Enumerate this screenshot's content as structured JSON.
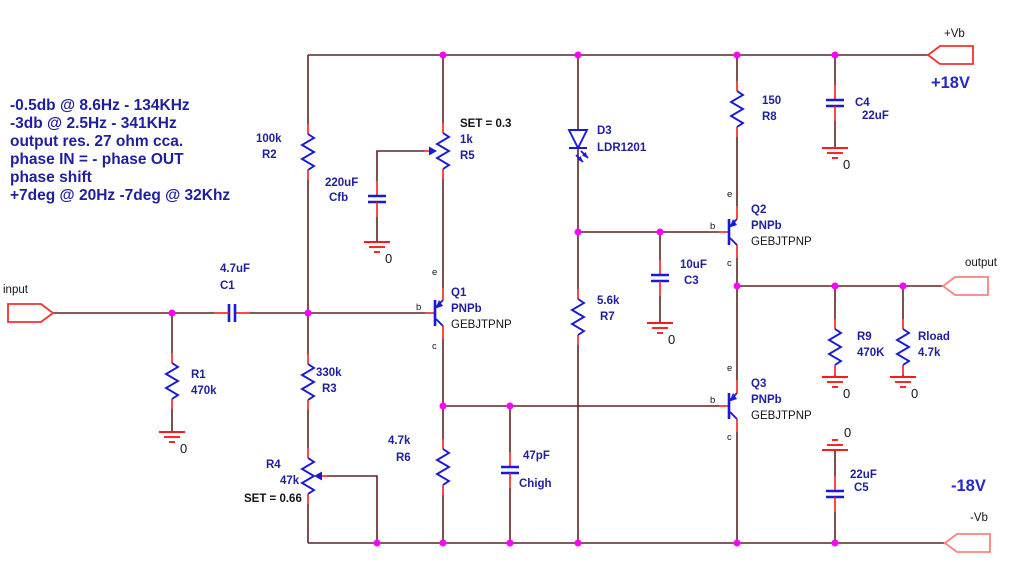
{
  "colors": {
    "wire": "#5f2424",
    "pin": "#ff1a1a",
    "body": "#1a1ad6",
    "dot": "#ff00ff",
    "label": "#1f1f9e",
    "ink": "#141414",
    "big": "#2626c9",
    "port": "#f53030",
    "portLight": "#ff8080",
    "bg": "#ffffff"
  },
  "annotations": {
    "lines": [
      "-0.5db @ 8.6Hz - 134KHz",
      "-3db @ 2.5Hz - 341KHz",
      "output res. 27 ohm cca.",
      "phase IN = - phase OUT",
      "phase shift",
      "+7deg @ 20Hz -7deg @ 32Khz"
    ]
  },
  "ports": {
    "input": {
      "label": "input"
    },
    "output": {
      "label": "output"
    },
    "vb_pos": {
      "label": "+Vb",
      "voltage": "+18V"
    },
    "vb_neg": {
      "label": "-Vb",
      "voltage": "-18V"
    }
  },
  "ground": {
    "label": "0"
  },
  "pins": {
    "e": "e",
    "b": "b",
    "c": "c"
  },
  "components": {
    "r1": {
      "ref": "R1",
      "value": "470k"
    },
    "r2": {
      "ref": "R2",
      "value": "100k"
    },
    "r3": {
      "ref": "R3",
      "value": "330k"
    },
    "r4": {
      "ref": "R4",
      "value": "47k",
      "set": "SET = 0.66"
    },
    "r5": {
      "ref": "R5",
      "value": "1k",
      "set": "SET = 0.3"
    },
    "r6": {
      "ref": "R6",
      "value": "4.7k"
    },
    "r7": {
      "ref": "R7",
      "value": "5.6k"
    },
    "r8": {
      "ref": "R8",
      "value": "150"
    },
    "r9": {
      "ref": "R9",
      "value": "470K"
    },
    "rload": {
      "ref": "Rload",
      "value": "4.7k"
    },
    "c1": {
      "ref": "C1",
      "value": "4.7uF"
    },
    "cfb": {
      "ref": "Cfb",
      "value": "220uF"
    },
    "c3": {
      "ref": "C3",
      "value": "10uF"
    },
    "c4": {
      "ref": "C4",
      "value": "22uF"
    },
    "c5": {
      "ref": "C5",
      "value": "22uF"
    },
    "chigh": {
      "ref": "Chigh",
      "value": "47pF"
    },
    "d3": {
      "ref": "D3",
      "value": "LDR1201"
    },
    "q1": {
      "ref": "Q1",
      "value": "PNPb",
      "model": "GEBJTPNP"
    },
    "q2": {
      "ref": "Q2",
      "value": "PNPb",
      "model": "GEBJTPNP"
    },
    "q3": {
      "ref": "Q3",
      "value": "PNPb",
      "model": "GEBJTPNP"
    }
  }
}
